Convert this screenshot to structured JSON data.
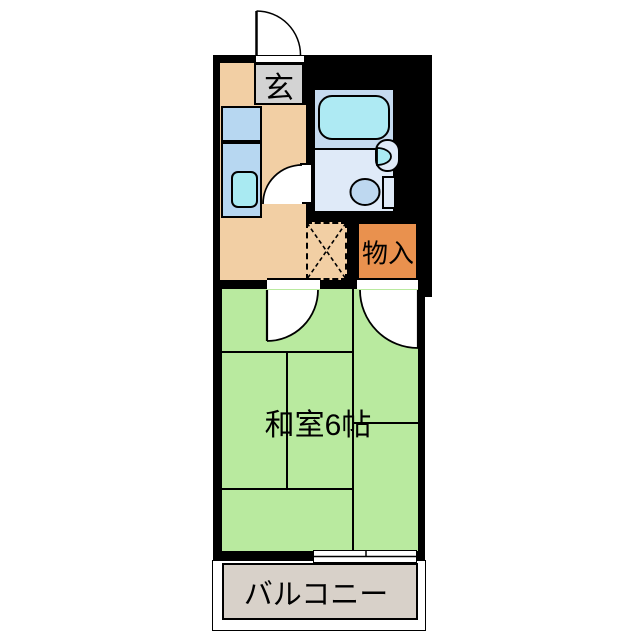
{
  "floorplan": {
    "type": "apartment-floor-plan",
    "labels": {
      "entrance": "玄",
      "storage": "物入",
      "main_room": "和室6帖",
      "balcony": "バルコニー"
    },
    "colors": {
      "wall": "#000000",
      "kitchen_floor": "#f2cfa4",
      "entrance_floor": "#d3d3d3",
      "counter_blue": "#b7d7f1",
      "sink_cyan": "#a9eaf2",
      "bathroom_floor": "#dfeaf8",
      "bath_zone_blue": "#c5daef",
      "bathtub_cyan": "#aeeaf3",
      "toilet_blue": "#bed8f0",
      "storage_orange": "#e9914e",
      "room_green": "#b9ea9f",
      "balcony_gray": "#d8d1c9"
    }
  }
}
